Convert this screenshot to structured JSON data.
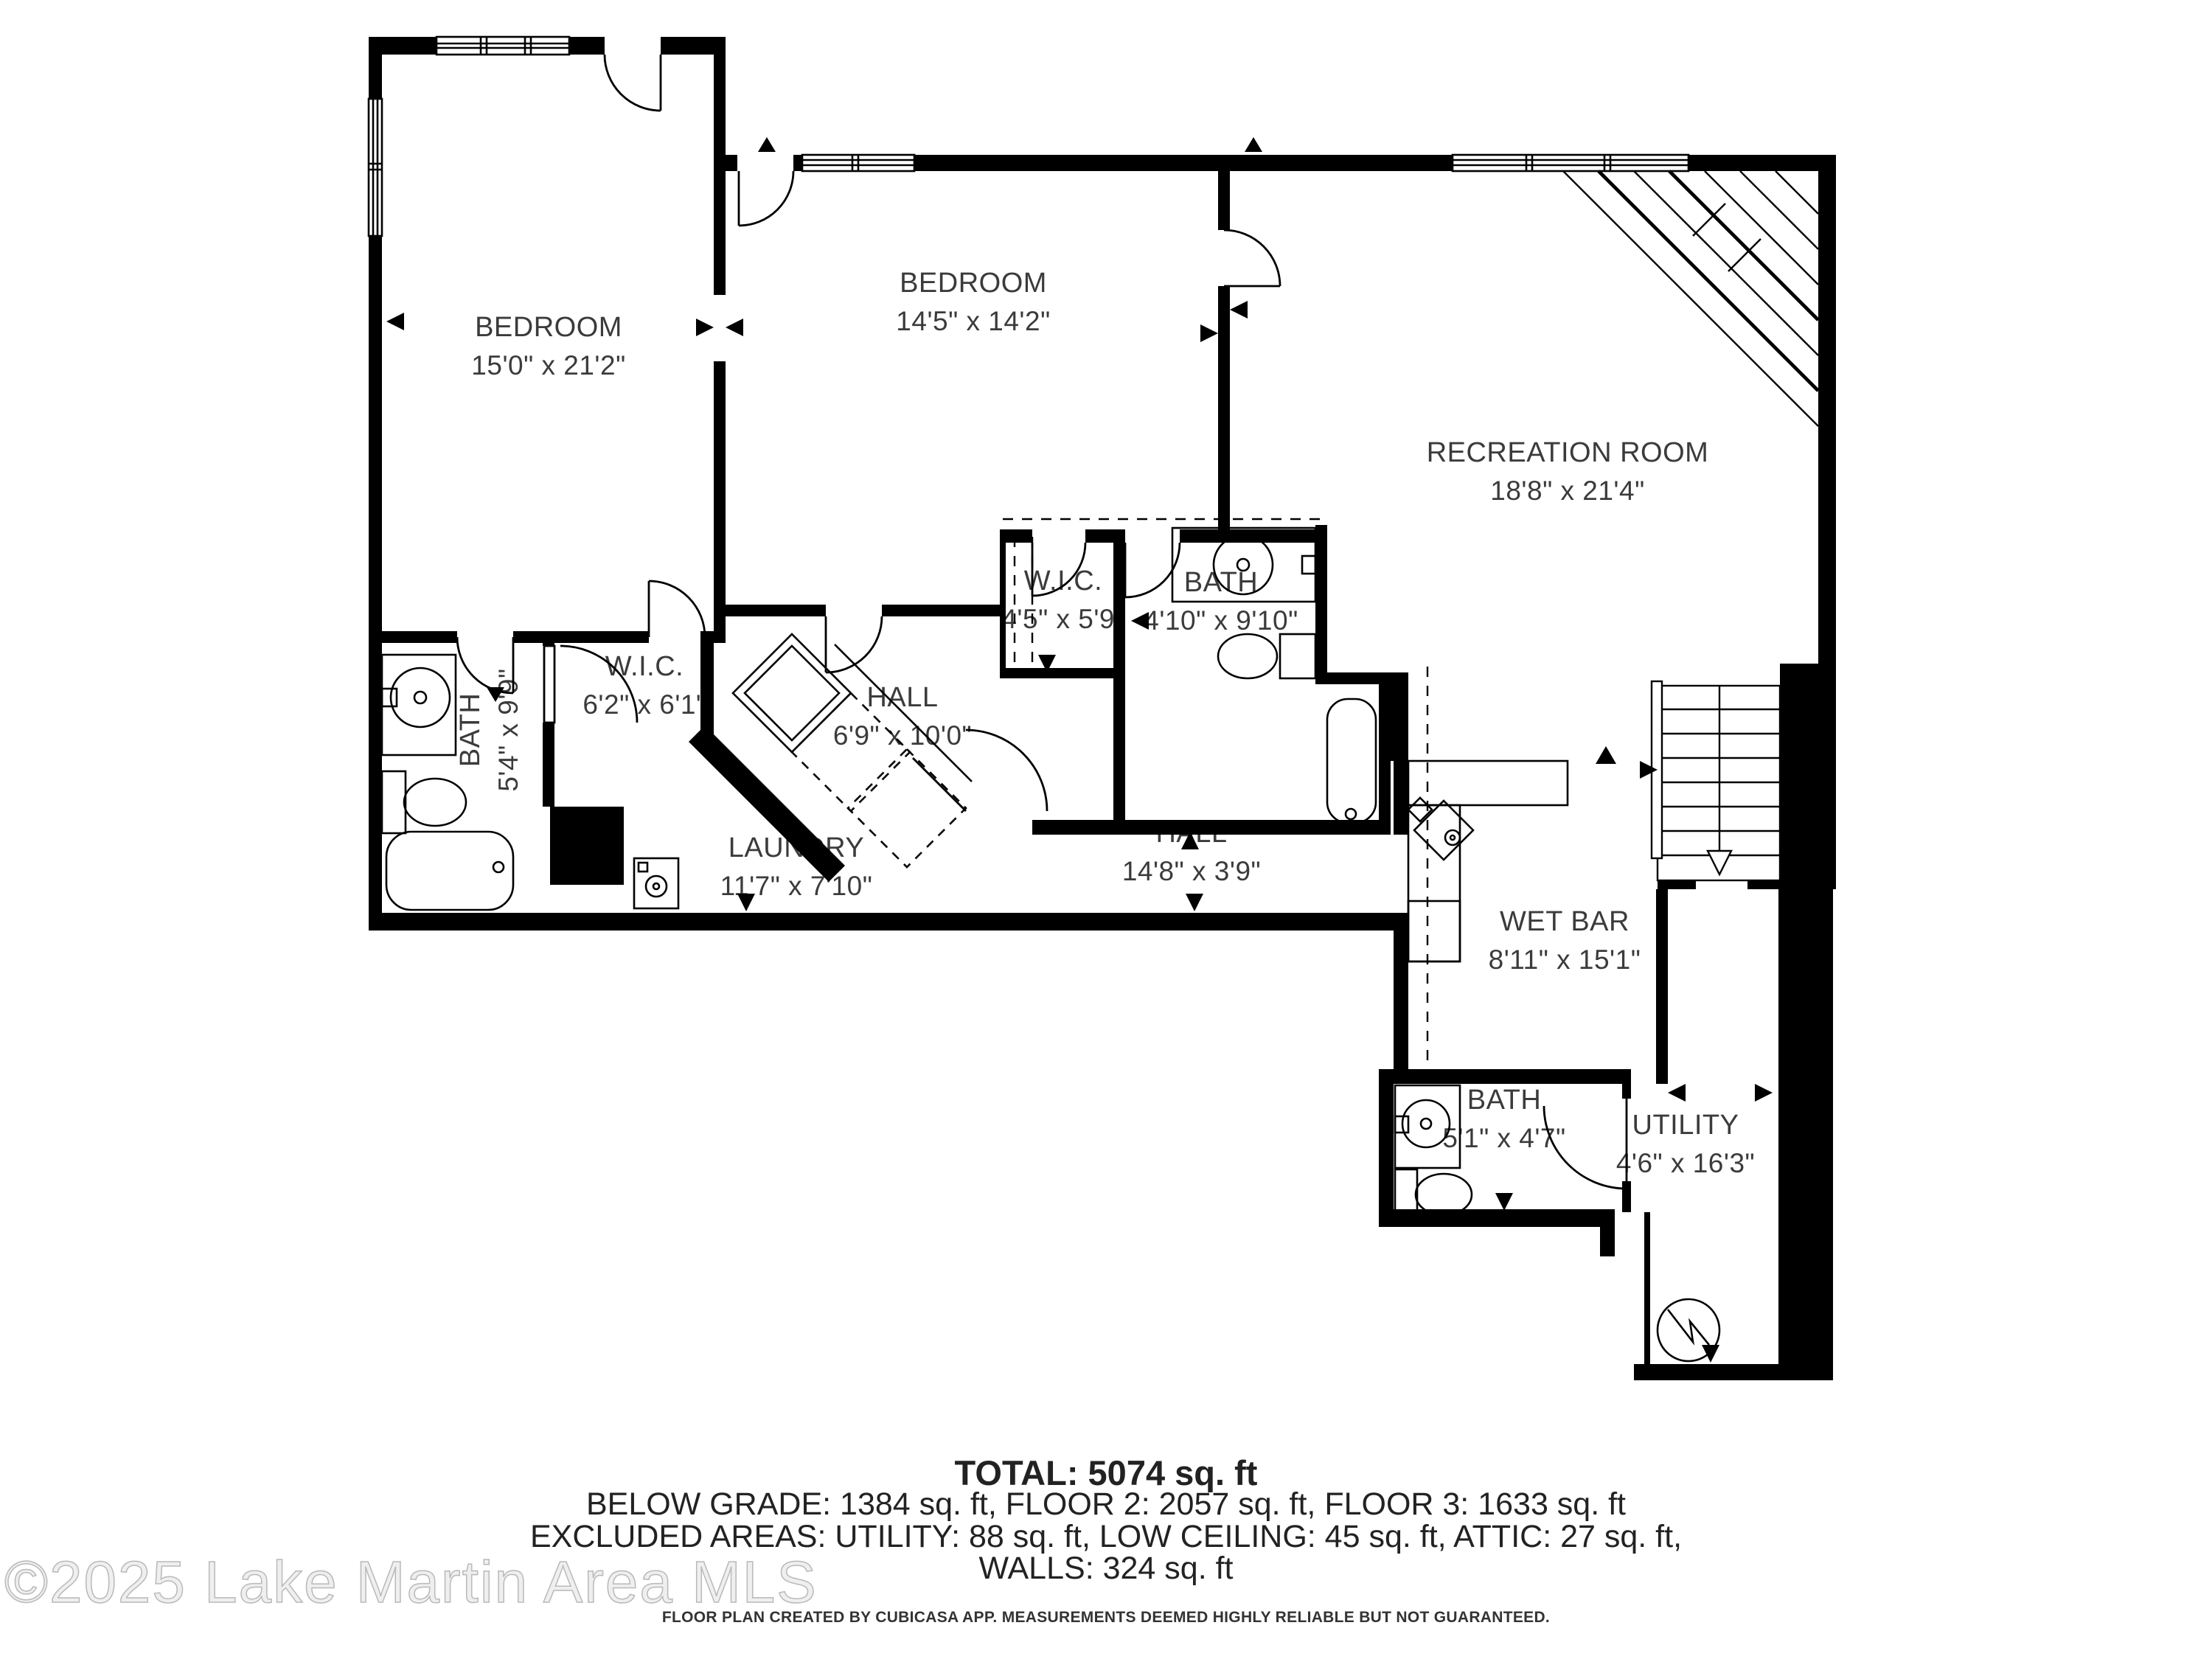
{
  "rooms": [
    {
      "name": "BEDROOM",
      "dims": "15'0\" x 21'2\""
    },
    {
      "name": "BEDROOM",
      "dims": "14'5\" x 14'2\""
    },
    {
      "name": "RECREATION ROOM",
      "dims": "18'8\" x 21'4\""
    },
    {
      "name": "W.I.C.",
      "dims": "4'5\" x 5'9\""
    },
    {
      "name": "BATH",
      "dims": "4'10\" x 9'10\""
    },
    {
      "name": "BATH",
      "dims": "5'4\" x 9'9\""
    },
    {
      "name": "W.I.C.",
      "dims": "6'2\" x 6'1\""
    },
    {
      "name": "HALL",
      "dims": "6'9\" x 10'0\""
    },
    {
      "name": "LAUNDRY",
      "dims": "11'7\" x 7'10\""
    },
    {
      "name": "HALL",
      "dims": "14'8\" x 3'9\""
    },
    {
      "name": "WET BAR",
      "dims": "8'11\" x 15'1\""
    },
    {
      "name": "BATH",
      "dims": "5'1\" x 4'7\""
    },
    {
      "name": "UTILITY",
      "dims": "4'6\" x 16'3\""
    }
  ],
  "summary": {
    "total": "TOTAL: 5074 sq. ft",
    "floors": "BELOW GRADE: 1384 sq. ft, FLOOR 2: 2057 sq. ft, FLOOR 3: 1633 sq. ft",
    "excluded": "EXCLUDED AREAS: UTILITY: 88 sq. ft, LOW CEILING: 45 sq. ft, ATTIC: 27 sq. ft,",
    "walls": "WALLS: 324 sq. ft"
  },
  "footer": {
    "disclaimer": "FLOOR PLAN CREATED BY CUBICASA APP. MEASUREMENTS DEEMED HIGHLY RELIABLE BUT NOT GUARANTEED."
  },
  "watermark": "©2025 Lake Martin Area MLS",
  "colors": {
    "wall": "#000000",
    "background": "#ffffff",
    "label": "#3b3b3b",
    "watermark": "#cccccc"
  }
}
